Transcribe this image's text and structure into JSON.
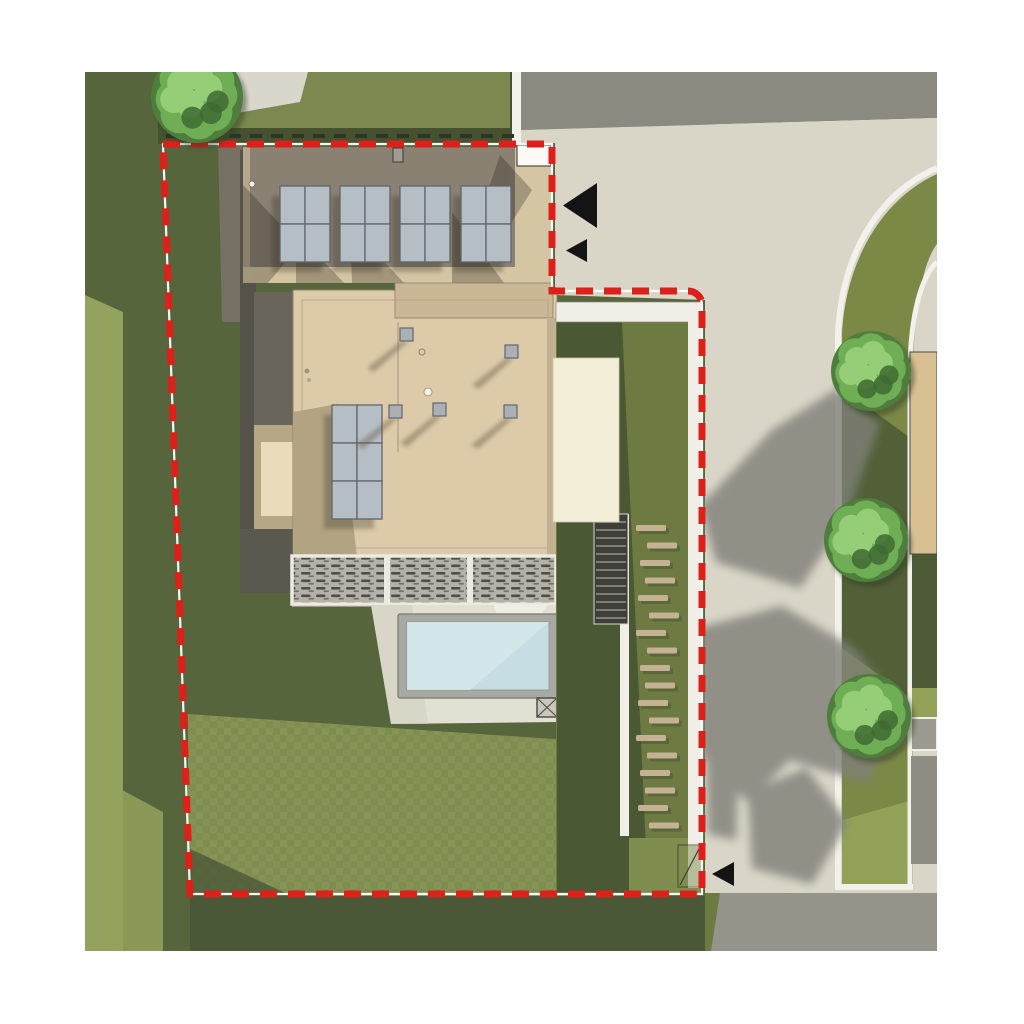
{
  "meta": {
    "title": "Residential site plan — aerial render",
    "type": "architectural top-down site plan",
    "canvas": {
      "w": 1024,
      "h": 1024
    }
  },
  "palette": {
    "page": "#ffffff",
    "grassDark": "#57653c",
    "grassShadow": "#4b5837",
    "grassMid": "#6d7b42",
    "grassLight": "#7f8e4e",
    "grassBright": "#93a25d",
    "hedge": "#46512f",
    "neighborLawn": "#7b8850",
    "pave": "#d9d7cb",
    "roadDark": "#8a8a81",
    "drive": "#d9d5c7",
    "driveShadow": "#7f8078",
    "verge": "#7b8846",
    "vergeShadow": "#4d5a36",
    "vergeBright": "#93a258",
    "curb": "#f2f1eb",
    "roofUpper": "#8b8173",
    "roofTan": "#d4c5a3",
    "roofMain": "#dccaa9",
    "roofBand": "#c9b795",
    "roofShade": "#b2a383",
    "panel": "#b6bec5",
    "panelLine": "#5f656c",
    "deckBg": "#b4b2a8",
    "deckFrame": "#eceae1",
    "deckSlat": "#3c3c37",
    "patio": "#e2e0d2",
    "poolCoping": "#a8a9a3",
    "poolWater": "#c6dee3",
    "poolWaterLight": "#d6e8eb",
    "pergola": "#f3eed8",
    "pathWhite": "#f0eee6",
    "stone": "#c4b292",
    "stairs": "#3f3f3a",
    "stairTread": "#93938a",
    "neighborBldg": "#d9c093",
    "roadBottom": "#95948b",
    "wallGray": "#767164",
    "wallDark": "#55524a",
    "courtFrame": "#b7a885",
    "courtPatch": "#e9dcba",
    "boundaryRed": "#de201b",
    "marker": "#141414",
    "treeDark": "#4f7d3d",
    "treeMid": "#6fae55",
    "treeLight": "#95ce77",
    "treeAccent": "#3f6b33",
    "notchWhite": "#fbfaf6"
  },
  "legend": {
    "boundary": "Red dashed site boundary",
    "markers": "Black survey arrow markers",
    "building": "Flat-roof house with rooftop solar arrays",
    "pool": "Swimming pool with coping and deck",
    "louvres": "Louvred slat deck strips",
    "stones": "Stepping-stone garden path",
    "verge": "Street verge with three trees"
  },
  "solar": {
    "upper": {
      "groupsX": [
        280,
        340,
        400,
        461
      ],
      "y": 186,
      "cols": 2,
      "rows": 2,
      "cellW": 25,
      "cellH": 38
    },
    "lower": {
      "x": 332,
      "y": 405,
      "cols": 2,
      "rows": 3,
      "cellW": 25,
      "cellH": 38
    }
  },
  "vents": [
    {
      "x": 400,
      "y": 328
    },
    {
      "x": 505,
      "y": 345
    },
    {
      "x": 389,
      "y": 405
    },
    {
      "x": 433,
      "y": 403
    },
    {
      "x": 504,
      "y": 405
    }
  ],
  "trees": [
    {
      "cx": 197,
      "cy": 97,
      "r": 46
    },
    {
      "cx": 871,
      "cy": 371,
      "r": 40
    },
    {
      "cx": 866,
      "cy": 540,
      "r": 42
    },
    {
      "cx": 869,
      "cy": 716,
      "r": 42
    }
  ],
  "stones": {
    "x1": 636,
    "x2": 645,
    "w": 30,
    "h": 6,
    "startY": 525,
    "stepY": 17.5,
    "count": 18
  },
  "markers": [
    {
      "x": 563,
      "y": 183,
      "w": 34,
      "h": 45
    },
    {
      "x": 566,
      "y": 239,
      "w": 21,
      "h": 23
    },
    {
      "x": 712,
      "y": 862,
      "w": 22,
      "h": 24
    }
  ]
}
